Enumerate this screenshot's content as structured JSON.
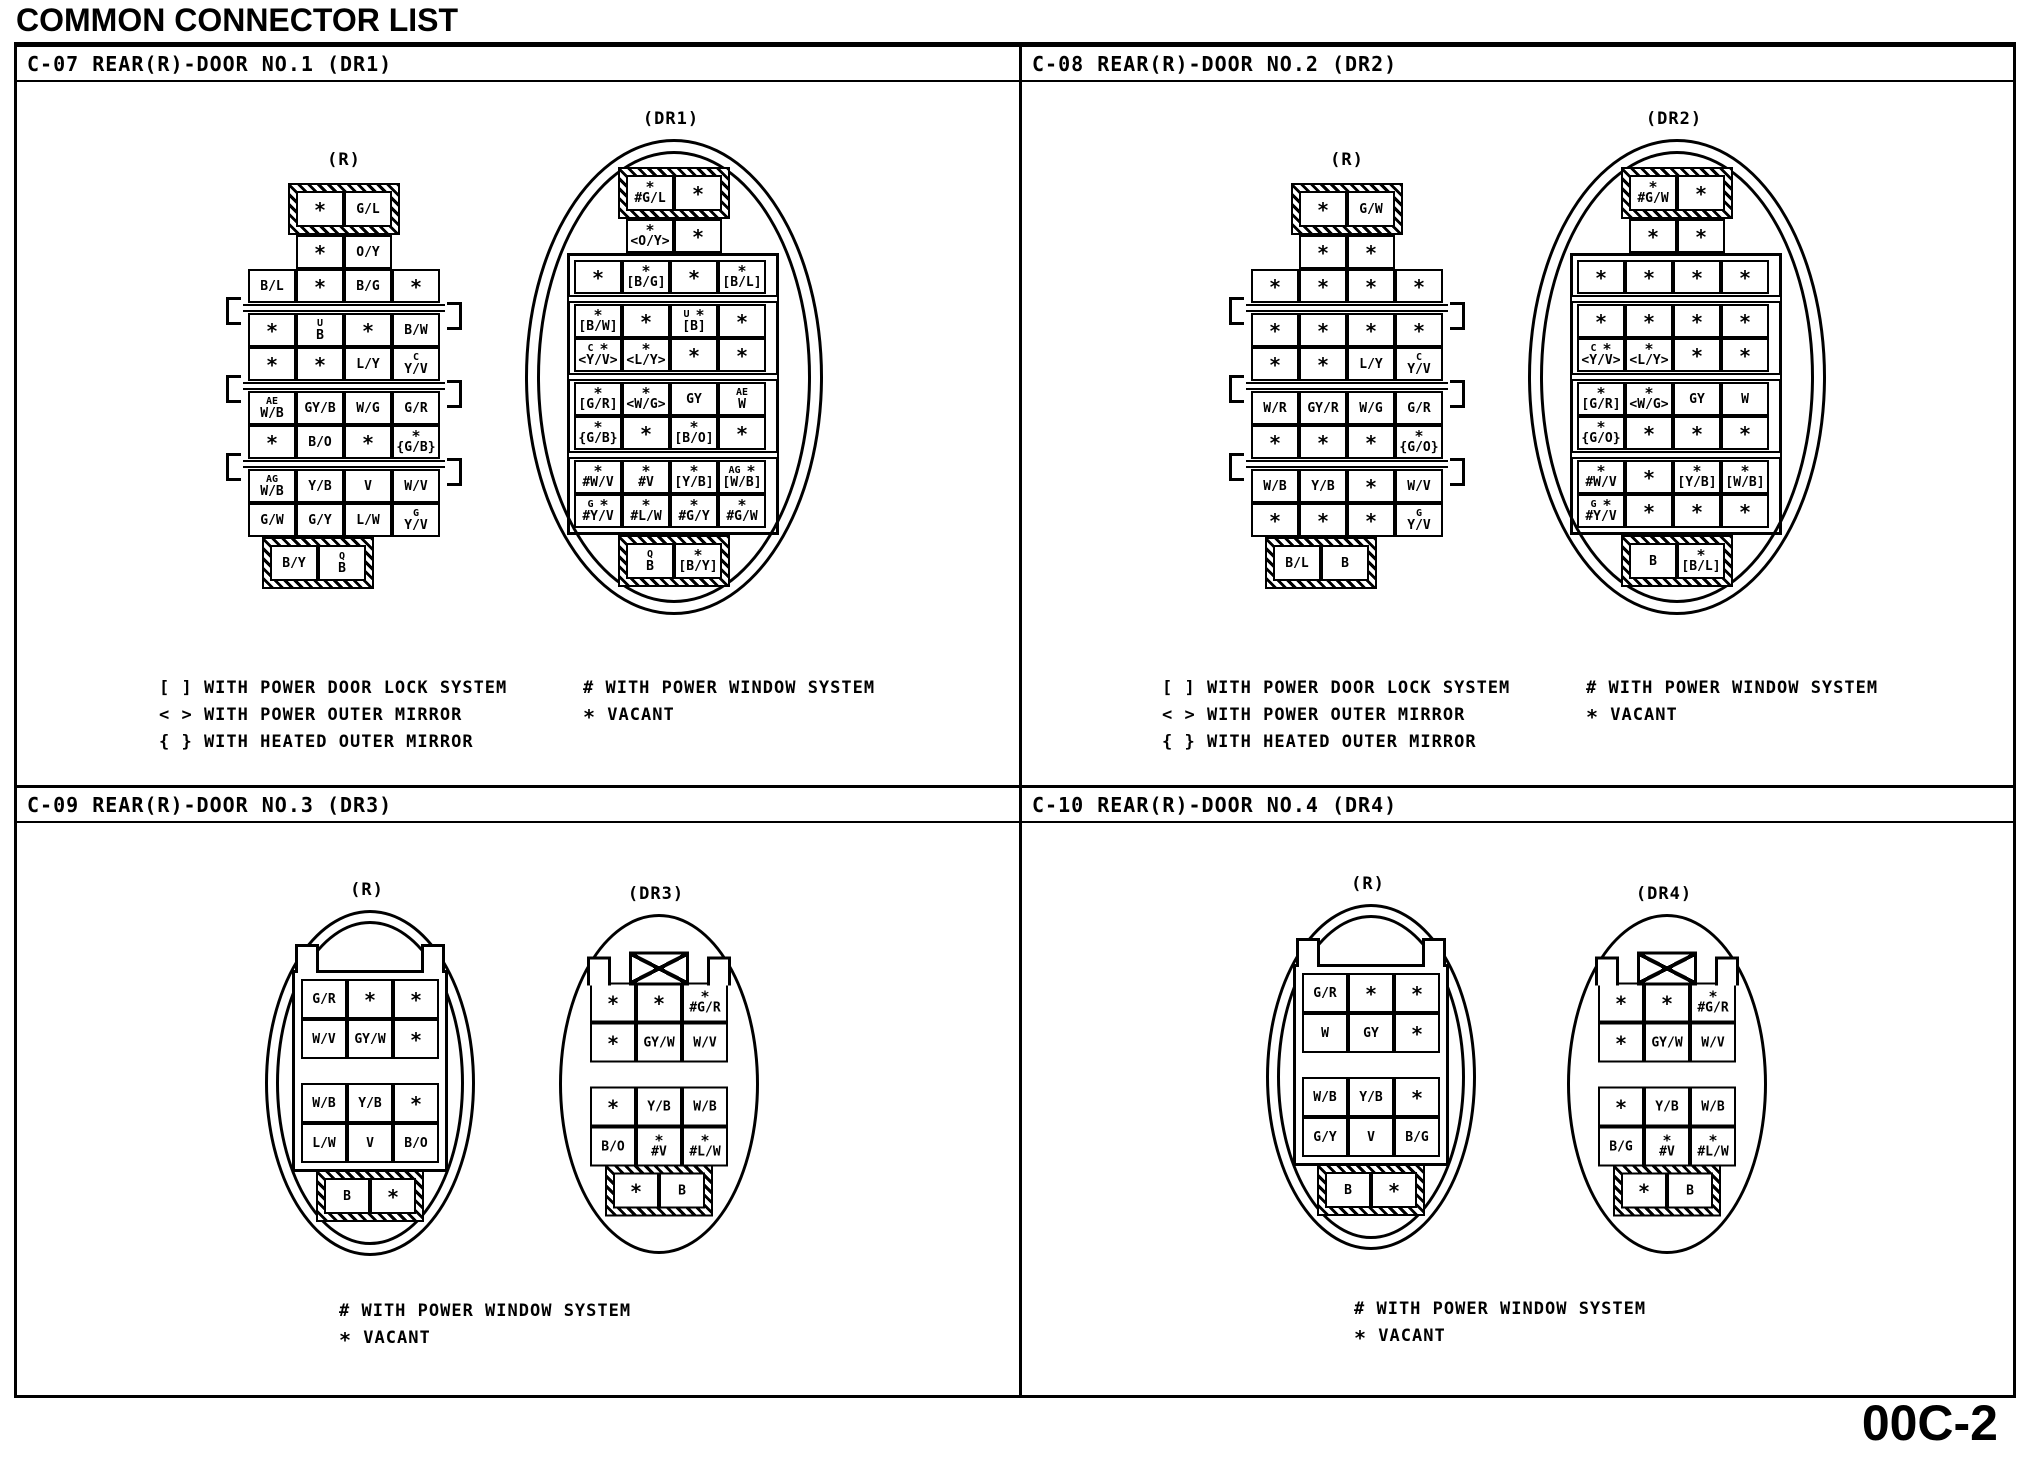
{
  "title": "COMMON CONNECTOR LIST",
  "page_number": "00C-2",
  "quadrants": [
    {
      "header": "C-07 REAR(R)-DOOR NO.1 (DR1)",
      "legend_left": [
        "[ ] WITH POWER DOOR LOCK SYSTEM",
        "< > WITH POWER OUTER MIRROR",
        "{ } WITH HEATED OUTER MIRROR"
      ],
      "legend_right": [
        "# WITH POWER WINDOW SYSTEM",
        "* VACANT"
      ],
      "connectors": [
        {
          "label": "(R)",
          "type": "ladder",
          "cap_top": [
            "*",
            "G/L"
          ],
          "narrow": [
            "*",
            "O/Y"
          ],
          "wide": [
            [
              "B/L",
              "*",
              "B/G",
              "*"
            ],
            [
              "*",
              {
                "sup": "U",
                "main": "B"
              },
              "*",
              "B/W"
            ],
            [
              "*",
              "*",
              "L/Y",
              {
                "sup": "C",
                "main": "Y/V"
              }
            ],
            [
              {
                "sup": "AE",
                "main": "W/B"
              },
              "GY/B",
              "W/G",
              "G/R"
            ],
            [
              "*",
              "B/O",
              "*",
              {
                "sup": "*",
                "main": "{G/B}"
              }
            ],
            [
              {
                "sup": "AG",
                "main": "W/B"
              },
              "Y/B",
              "V",
              "W/V"
            ],
            [
              "G/W",
              "G/Y",
              "L/W",
              {
                "sup": "G",
                "main": "Y/V"
              }
            ]
          ],
          "cap_bottom": [
            "B/Y",
            {
              "sup": "Q",
              "main": "B"
            }
          ]
        },
        {
          "label": "(DR1)",
          "type": "ladder-oval",
          "cap_top": [
            {
              "sup": "*",
              "main": "#G/L"
            },
            "*"
          ],
          "narrow": [
            {
              "sup": "*",
              "main": "<O/Y>"
            },
            "*"
          ],
          "wide": [
            [
              "*",
              {
                "sup": "*",
                "main": "[B/G]"
              },
              "*",
              {
                "sup": "*",
                "main": "[B/L]"
              }
            ],
            [
              {
                "sup": "*",
                "main": "[B/W]"
              },
              "*",
              {
                "sup": "U *",
                "main": "[B]"
              },
              "*"
            ],
            [
              {
                "sup": "C *",
                "main": "<Y/V>"
              },
              {
                "sup": "*",
                "main": "<L/Y>"
              },
              "*",
              "*"
            ],
            [
              {
                "sup": "*",
                "main": "[G/R]"
              },
              {
                "sup": "*",
                "main": "<W/G>"
              },
              "GY",
              {
                "sup": "AE",
                "main": "W"
              }
            ],
            [
              {
                "sup": "*",
                "main": "{G/B}"
              },
              "*",
              {
                "sup": "*",
                "main": "[B/O]"
              },
              "*"
            ],
            [
              {
                "sup": "*",
                "main": "#W/V"
              },
              {
                "sup": "*",
                "main": "#V"
              },
              {
                "sup": "*",
                "main": "[Y/B]"
              },
              {
                "sup": "AG *",
                "main": "[W/B]"
              }
            ],
            [
              {
                "sup": "G *",
                "main": "#Y/V"
              },
              {
                "sup": "*",
                "main": "#L/W"
              },
              {
                "sup": "*",
                "main": "#G/Y"
              },
              {
                "sup": "*",
                "main": "#G/W"
              }
            ]
          ],
          "cap_bottom": [
            {
              "sup": "Q",
              "main": "B"
            },
            {
              "sup": "*",
              "main": "[B/Y]"
            }
          ]
        }
      ]
    },
    {
      "header": "C-08 REAR(R)-DOOR NO.2 (DR2)",
      "legend_left": [
        "[ ] WITH POWER DOOR LOCK SYSTEM",
        "< > WITH POWER OUTER MIRROR",
        "{ } WITH HEATED OUTER MIRROR"
      ],
      "legend_right": [
        "# WITH POWER WINDOW SYSTEM",
        "* VACANT"
      ],
      "connectors": [
        {
          "label": "(R)",
          "type": "ladder",
          "cap_top": [
            "*",
            "G/W"
          ],
          "narrow": [
            "*",
            "*"
          ],
          "wide": [
            [
              "*",
              "*",
              "*",
              "*"
            ],
            [
              "*",
              "*",
              "*",
              "*"
            ],
            [
              "*",
              "*",
              "L/Y",
              {
                "sup": "C",
                "main": "Y/V"
              }
            ],
            [
              "W/R",
              "GY/R",
              "W/G",
              "G/R"
            ],
            [
              "*",
              "*",
              "*",
              {
                "sup": "*",
                "main": "{G/O}"
              }
            ],
            [
              "W/B",
              "Y/B",
              "*",
              "W/V"
            ],
            [
              "*",
              "*",
              "*",
              {
                "sup": "G",
                "main": "Y/V"
              }
            ]
          ],
          "cap_bottom": [
            "B/L",
            "B"
          ]
        },
        {
          "label": "(DR2)",
          "type": "ladder-oval",
          "cap_top": [
            {
              "sup": "*",
              "main": "#G/W"
            },
            "*"
          ],
          "narrow": [
            "*",
            "*"
          ],
          "wide": [
            [
              "*",
              "*",
              "*",
              "*"
            ],
            [
              "*",
              "*",
              "*",
              "*"
            ],
            [
              {
                "sup": "C *",
                "main": "<Y/V>"
              },
              {
                "sup": "*",
                "main": "<L/Y>"
              },
              "*",
              "*"
            ],
            [
              {
                "sup": "*",
                "main": "[G/R]"
              },
              {
                "sup": "*",
                "main": "<W/G>"
              },
              "GY",
              "W"
            ],
            [
              {
                "sup": "*",
                "main": "{G/O}"
              },
              "*",
              "*",
              "*"
            ],
            [
              {
                "sup": "*",
                "main": "#W/V"
              },
              "*",
              {
                "sup": "*",
                "main": "[Y/B]"
              },
              {
                "sup": "*",
                "main": "[W/B]"
              }
            ],
            [
              {
                "sup": "G *",
                "main": "#Y/V"
              },
              "*",
              "*",
              "*"
            ]
          ],
          "cap_bottom": [
            "B",
            {
              "sup": "*",
              "main": "[B/L]"
            }
          ]
        }
      ]
    },
    {
      "header": "C-09 REAR(R)-DOOR NO.3 (DR3)",
      "legend_left": [
        "# WITH POWER WINDOW SYSTEM",
        "* VACANT"
      ],
      "legend_right": [],
      "connectors": [
        {
          "label": "(R)",
          "type": "oval-r",
          "block1": [
            [
              "G/R",
              "*",
              "*"
            ],
            [
              "W/V",
              "GY/W",
              "*"
            ]
          ],
          "block2": [
            [
              "W/B",
              "Y/B",
              "*"
            ],
            [
              "L/W",
              "V",
              "B/O"
            ]
          ],
          "cap": [
            "B",
            "*"
          ]
        },
        {
          "label": "(DR3)",
          "type": "oval-dr",
          "block1": [
            [
              "*",
              "*",
              {
                "sup": "*",
                "main": "#G/R"
              }
            ],
            [
              "*",
              "GY/W",
              "W/V"
            ]
          ],
          "block2": [
            [
              "*",
              "Y/B",
              "W/B"
            ],
            [
              "B/O",
              {
                "sup": "*",
                "main": "#V"
              },
              {
                "sup": "*",
                "main": "#L/W"
              }
            ]
          ],
          "cap": [
            "*",
            "B"
          ]
        }
      ]
    },
    {
      "header": "C-10 REAR(R)-DOOR NO.4 (DR4)",
      "legend_left": [
        "# WITH POWER WINDOW SYSTEM",
        "* VACANT"
      ],
      "legend_right": [],
      "connectors": [
        {
          "label": "(R)",
          "type": "oval-r",
          "block1": [
            [
              "G/R",
              "*",
              "*"
            ],
            [
              "W",
              "GY",
              "*"
            ]
          ],
          "block2": [
            [
              "W/B",
              "Y/B",
              "*"
            ],
            [
              "G/Y",
              "V",
              "B/G"
            ]
          ],
          "cap": [
            "B",
            "*"
          ]
        },
        {
          "label": "(DR4)",
          "type": "oval-dr",
          "block1": [
            [
              "*",
              "*",
              {
                "sup": "*",
                "main": "#G/R"
              }
            ],
            [
              "*",
              "GY/W",
              "W/V"
            ]
          ],
          "block2": [
            [
              "*",
              "Y/B",
              "W/B"
            ],
            [
              "B/G",
              {
                "sup": "*",
                "main": "#V"
              },
              {
                "sup": "*",
                "main": "#L/W"
              }
            ]
          ],
          "cap": [
            "*",
            "B"
          ]
        }
      ]
    }
  ]
}
